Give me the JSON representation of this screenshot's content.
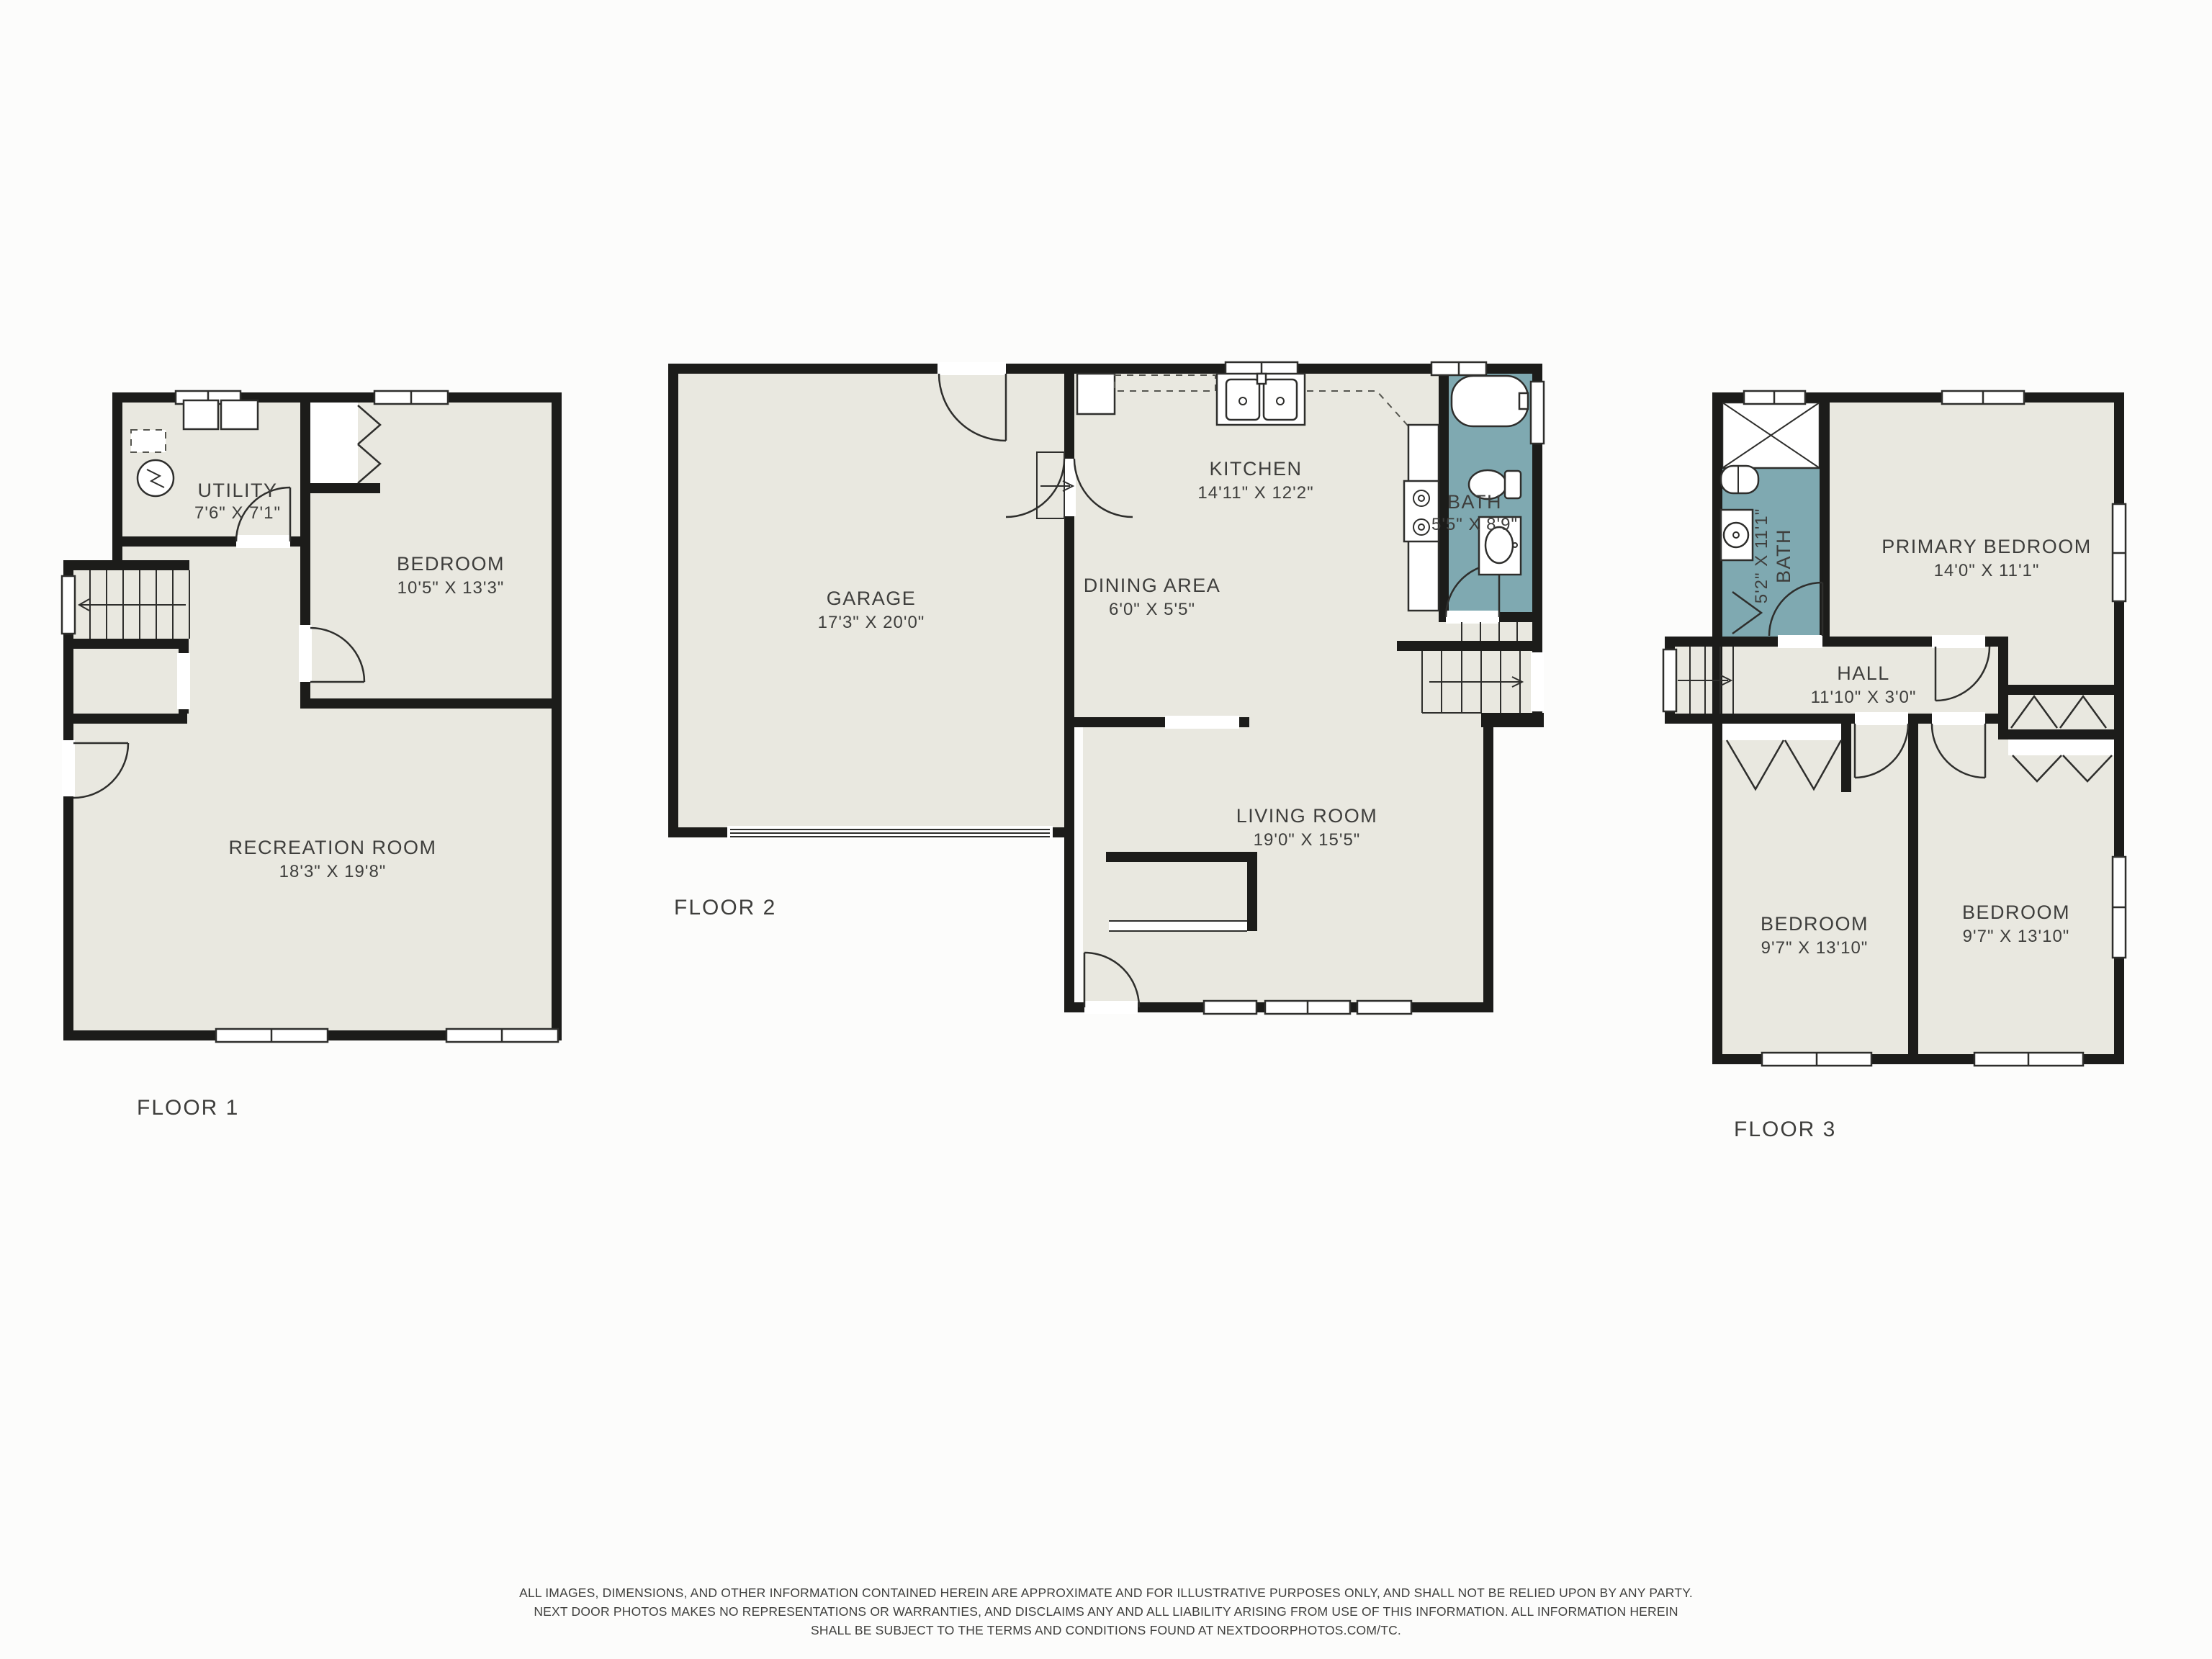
{
  "colors": {
    "background": "#fcfcfb",
    "floor_fill": "#e9e8e0",
    "bath_fill": "#7fa9b1",
    "wall": "#1c1c1a",
    "line": "#2e2e2c",
    "text": "#3e3e3c"
  },
  "floor1": {
    "label": "FLOOR 1",
    "utility": {
      "name": "UTILITY",
      "dims": "7'6\" X 7'1\""
    },
    "bedroom": {
      "name": "BEDROOM",
      "dims": "10'5\" X 13'3\""
    },
    "recreation": {
      "name": "RECREATION ROOM",
      "dims": "18'3\" X 19'8\""
    }
  },
  "floor2": {
    "label": "FLOOR 2",
    "garage": {
      "name": "GARAGE",
      "dims": "17'3\" X 20'0\""
    },
    "kitchen": {
      "name": "KITCHEN",
      "dims": "14'11\" X 12'2\""
    },
    "dining": {
      "name": "DINING AREA",
      "dims": "6'0\" X 5'5\""
    },
    "bath": {
      "name": "BATH",
      "dims": "5'5\" X 8'9\""
    },
    "living": {
      "name": "LIVING ROOM",
      "dims": "19'0\" X 15'5\""
    }
  },
  "floor3": {
    "label": "FLOOR 3",
    "primary": {
      "name": "PRIMARY BEDROOM",
      "dims": "14'0\" X 11'1\""
    },
    "bath": {
      "name": "BATH",
      "dims": "5'2\" X 11'1\""
    },
    "hall": {
      "name": "HALL",
      "dims": "11'10\" X 3'0\""
    },
    "bedroom_left": {
      "name": "BEDROOM",
      "dims": "9'7\" X 13'10\""
    },
    "bedroom_right": {
      "name": "BEDROOM",
      "dims": "9'7\" X 13'10\""
    }
  },
  "disclaimer": {
    "line1": "ALL IMAGES, DIMENSIONS, AND OTHER INFORMATION CONTAINED HEREIN ARE APPROXIMATE AND FOR ILLUSTRATIVE PURPOSES ONLY, AND SHALL NOT BE RELIED UPON BY ANY PARTY.",
    "line2": "NEXT DOOR PHOTOS MAKES NO REPRESENTATIONS OR WARRANTIES, AND DISCLAIMS ANY AND ALL LIABILITY ARISING FROM USE OF THIS INFORMATION. ALL INFORMATION HEREIN",
    "line3": "SHALL BE SUBJECT TO THE TERMS AND CONDITIONS FOUND AT NEXTDOORPHOTOS.COM/TC."
  }
}
